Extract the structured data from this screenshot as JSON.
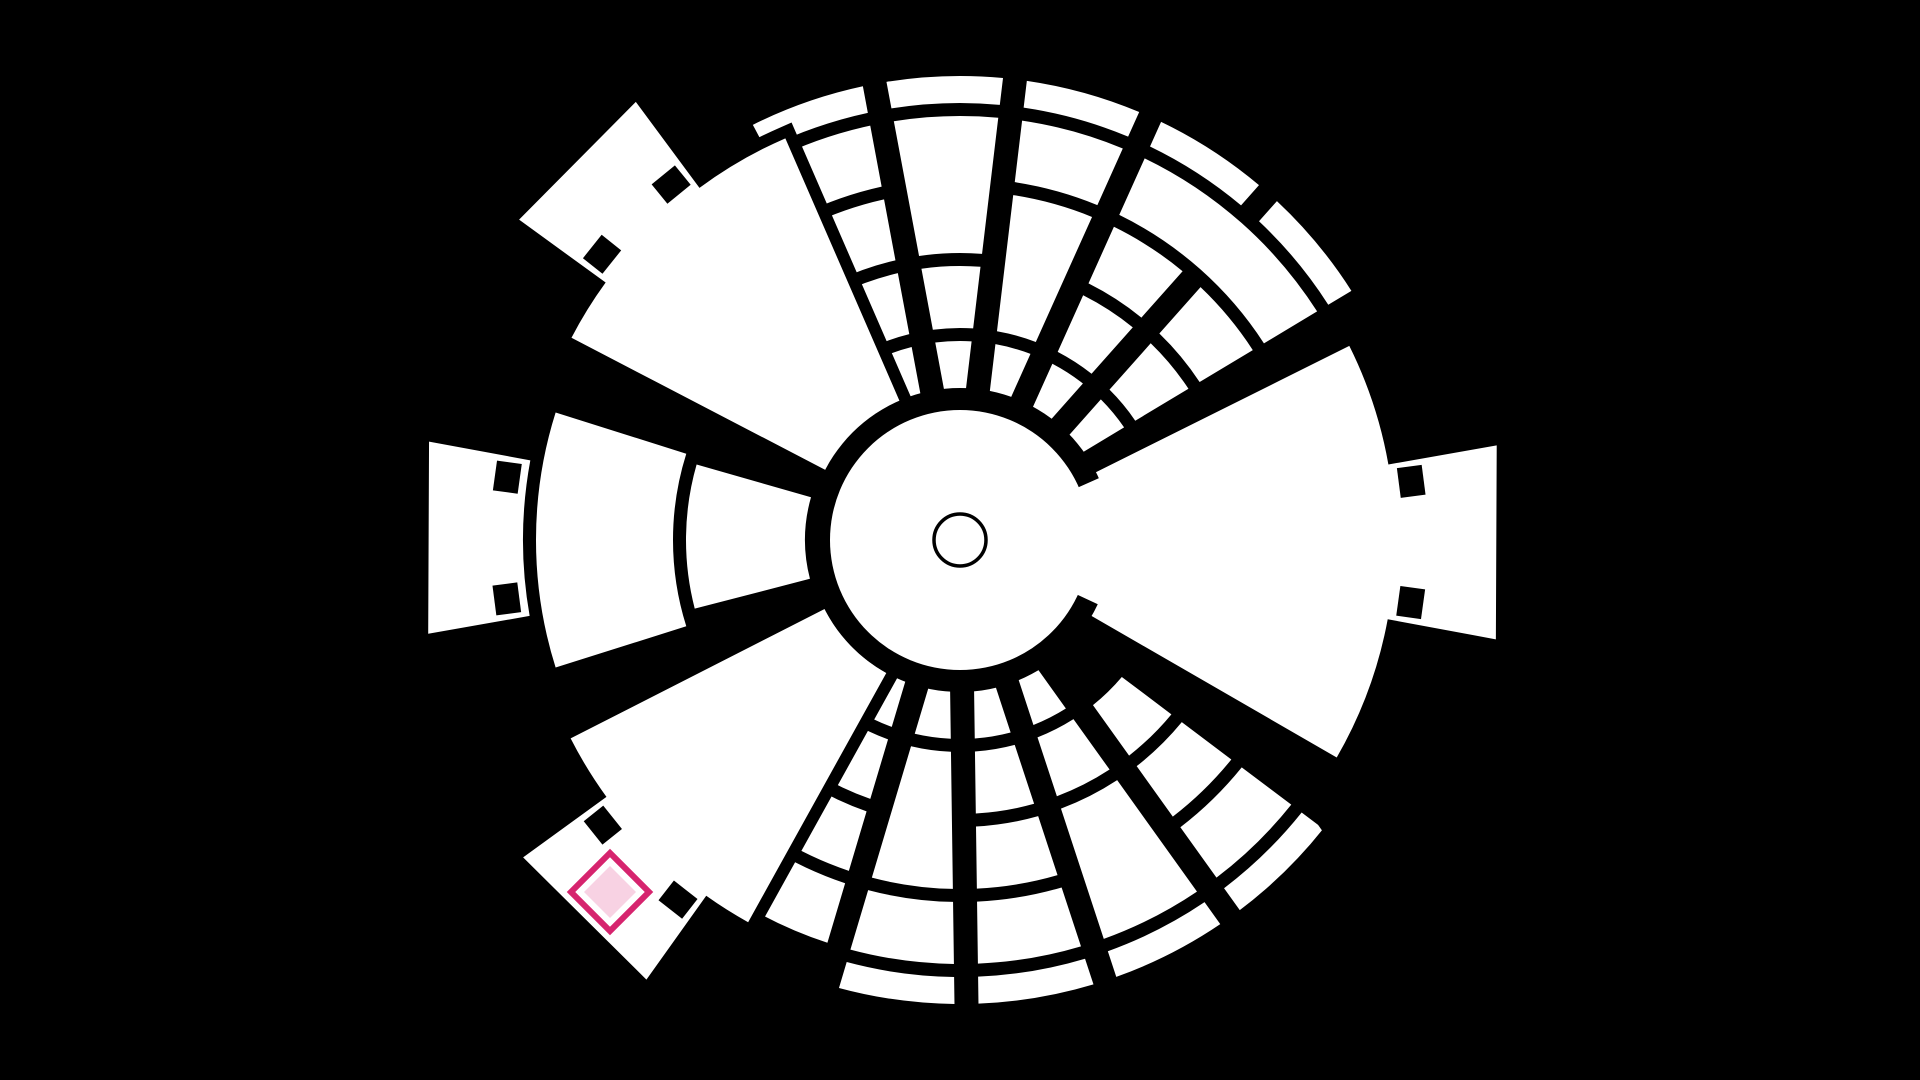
{
  "scene": {
    "description": "polar dungeon map on black background",
    "colors": {
      "background": "#000000",
      "floor": "#ffffff",
      "wall": "#000000",
      "marker_stroke": "#d6246e",
      "marker_gap": "#ffffff",
      "marker_fill": "#f8d2e3"
    }
  },
  "canvas": {
    "width": 1920,
    "height": 1080,
    "cx": 960,
    "cy": 540
  },
  "center": {
    "disc_radius": 130,
    "gap_ring_radius": 152,
    "token_circle_radius": 26,
    "token_circle_stroke_width": 3.5
  },
  "gaps": {
    "hall_outline_width": 24,
    "cell_angular_inset_px": 12
  },
  "ring_bands": [
    [
      150,
      199
    ],
    [
      212,
      274
    ],
    [
      287,
      349
    ],
    [
      362,
      424
    ],
    [
      437,
      464
    ]
  ],
  "halls": [
    {
      "id": "hall-east",
      "ri": 112,
      "rb": 435,
      "a0": -26.5,
      "a1": 30,
      "t0": -10,
      "t1": 10.5,
      "rt": 545,
      "connected_to_center": true
    },
    {
      "id": "hall-north-west",
      "ri": 150,
      "rb": 438,
      "a0": -152.5,
      "a1": -113.5,
      "t0": -144,
      "t1": -126.5,
      "rt": 545,
      "connected_to_center": false
    },
    {
      "id": "hall-south-west",
      "ri": 152,
      "rb": 437,
      "a0": 119,
      "a1": 153,
      "t0": 125.5,
      "t1": 144,
      "rt": 540,
      "connected_to_center": false
    }
  ],
  "west_wing": {
    "id": "wing-west",
    "segments": [
      {
        "r0": 155,
        "r1": 274,
        "a0": 165.5,
        "a1": 196
      },
      {
        "r0": 287,
        "r1": 424,
        "a0": 162.5,
        "a1": 197.5
      }
    ],
    "tab": {
      "r0": 437,
      "t0": 170,
      "t1": 190.5,
      "rt": 540
    }
  },
  "notch": {
    "tangential": 30,
    "radial": 25,
    "radial_offset": 20,
    "angle_inset_deg": 2.6
  },
  "connector": {
    "r0": 118,
    "r1": 166,
    "a0": -24,
    "a1": 25
  },
  "grids": [
    {
      "id": "grid-north",
      "col_bounds": [
        -118,
        -100.6,
        -83.2,
        -65.8,
        -48.4,
        -31
      ],
      "cells": [
        [
          0,
          0,
          0,
          0
        ],
        [
          0,
          0,
          1,
          1
        ],
        [
          0,
          0,
          2,
          2
        ],
        [
          0,
          0,
          3,
          3
        ],
        [
          0,
          0,
          4,
          4
        ],
        [
          1,
          1,
          0,
          0
        ],
        [
          1,
          1,
          1,
          1
        ],
        [
          1,
          1,
          2,
          3
        ],
        [
          1,
          1,
          4,
          4
        ],
        [
          2,
          2,
          0,
          0
        ],
        [
          2,
          2,
          1,
          2
        ],
        [
          2,
          2,
          3,
          3
        ],
        [
          2,
          2,
          4,
          4
        ],
        [
          3,
          3,
          0,
          0
        ],
        [
          3,
          3,
          1,
          1
        ],
        [
          3,
          3,
          2,
          2
        ],
        [
          3,
          4,
          3,
          3
        ],
        [
          3,
          3,
          4,
          4
        ],
        [
          4,
          4,
          0,
          0
        ],
        [
          4,
          4,
          1,
          1
        ],
        [
          4,
          4,
          2,
          2
        ],
        [
          4,
          4,
          4,
          4
        ]
      ]
    },
    {
      "id": "grid-south",
      "col_bounds": [
        37,
        54.4,
        71.8,
        89.2,
        106.6,
        124
      ],
      "cells": [
        [
          0,
          0,
          1,
          1
        ],
        [
          0,
          0,
          2,
          2
        ],
        [
          0,
          0,
          3,
          3
        ],
        [
          0,
          0,
          4,
          4
        ],
        [
          1,
          1,
          0,
          0
        ],
        [
          1,
          1,
          1,
          1
        ],
        [
          1,
          1,
          2,
          3
        ],
        [
          1,
          1,
          4,
          4
        ],
        [
          2,
          2,
          0,
          0
        ],
        [
          2,
          2,
          1,
          1
        ],
        [
          2,
          2,
          2,
          2
        ],
        [
          2,
          2,
          3,
          3
        ],
        [
          2,
          2,
          4,
          4
        ],
        [
          3,
          3,
          0,
          0
        ],
        [
          3,
          3,
          1,
          2
        ],
        [
          3,
          3,
          3,
          3
        ],
        [
          3,
          3,
          4,
          4
        ],
        [
          4,
          4,
          0,
          0
        ],
        [
          4,
          4,
          1,
          1
        ],
        [
          4,
          4,
          2,
          2
        ],
        [
          4,
          4,
          3,
          3
        ]
      ]
    }
  ],
  "extra_gap_bands": [
    {
      "x1": 1168,
      "y1": 588,
      "x2": 1360,
      "y2": 862,
      "width": 26
    }
  ],
  "marker": {
    "x": 610,
    "y": 892,
    "outer_half_diag": 39,
    "stroke_width": 6,
    "inner_half_diag": 26
  }
}
